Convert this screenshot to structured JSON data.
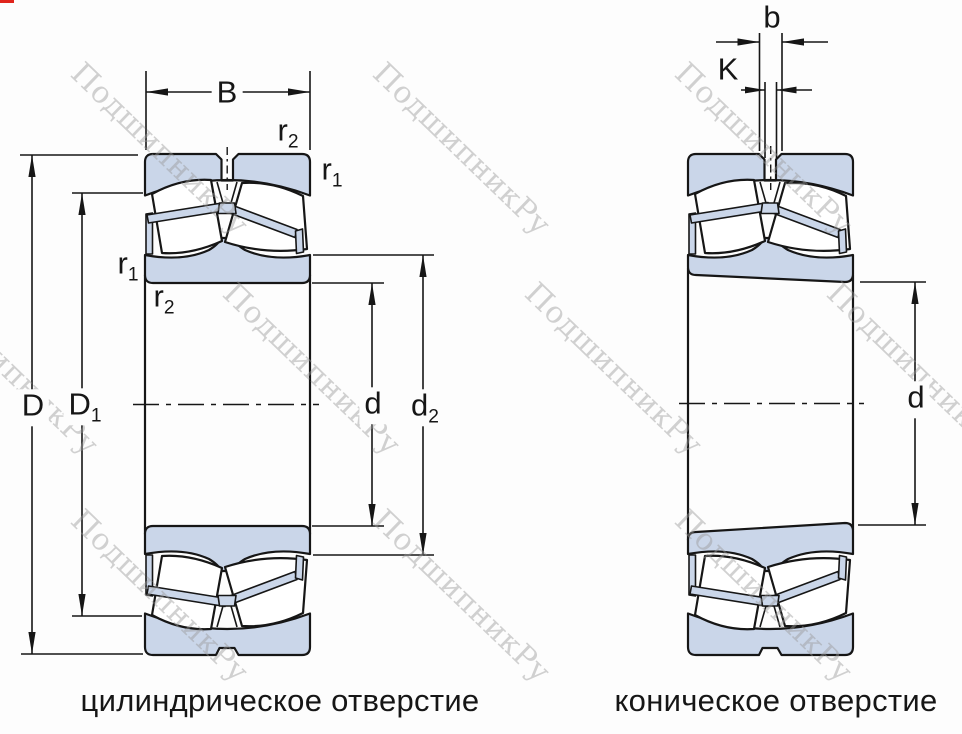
{
  "watermark": {
    "text": "ПодшипникРу"
  },
  "captions": {
    "left": "цилиндрическое отверстие",
    "right": "коническое отверстие"
  },
  "dimensions": {
    "B": {
      "base": "B",
      "sub": ""
    },
    "r2_top": {
      "base": "r",
      "sub": "2"
    },
    "r1_right": {
      "base": "r",
      "sub": "1"
    },
    "r1_left": {
      "base": "r",
      "sub": "1"
    },
    "r2_left": {
      "base": "r",
      "sub": "2"
    },
    "D": {
      "base": "D",
      "sub": ""
    },
    "D1": {
      "base": "D",
      "sub": "1"
    },
    "d_left": {
      "base": "d",
      "sub": ""
    },
    "d2": {
      "base": "d",
      "sub": "2"
    },
    "b": {
      "base": "b",
      "sub": ""
    },
    "K": {
      "base": "K",
      "sub": ""
    },
    "d_right": {
      "base": "d",
      "sub": ""
    }
  },
  "colors": {
    "ring_fill": "#cad6e9",
    "line": "#161616",
    "watermark": "#9a9a9a",
    "artifact_red": "#e0241c"
  }
}
